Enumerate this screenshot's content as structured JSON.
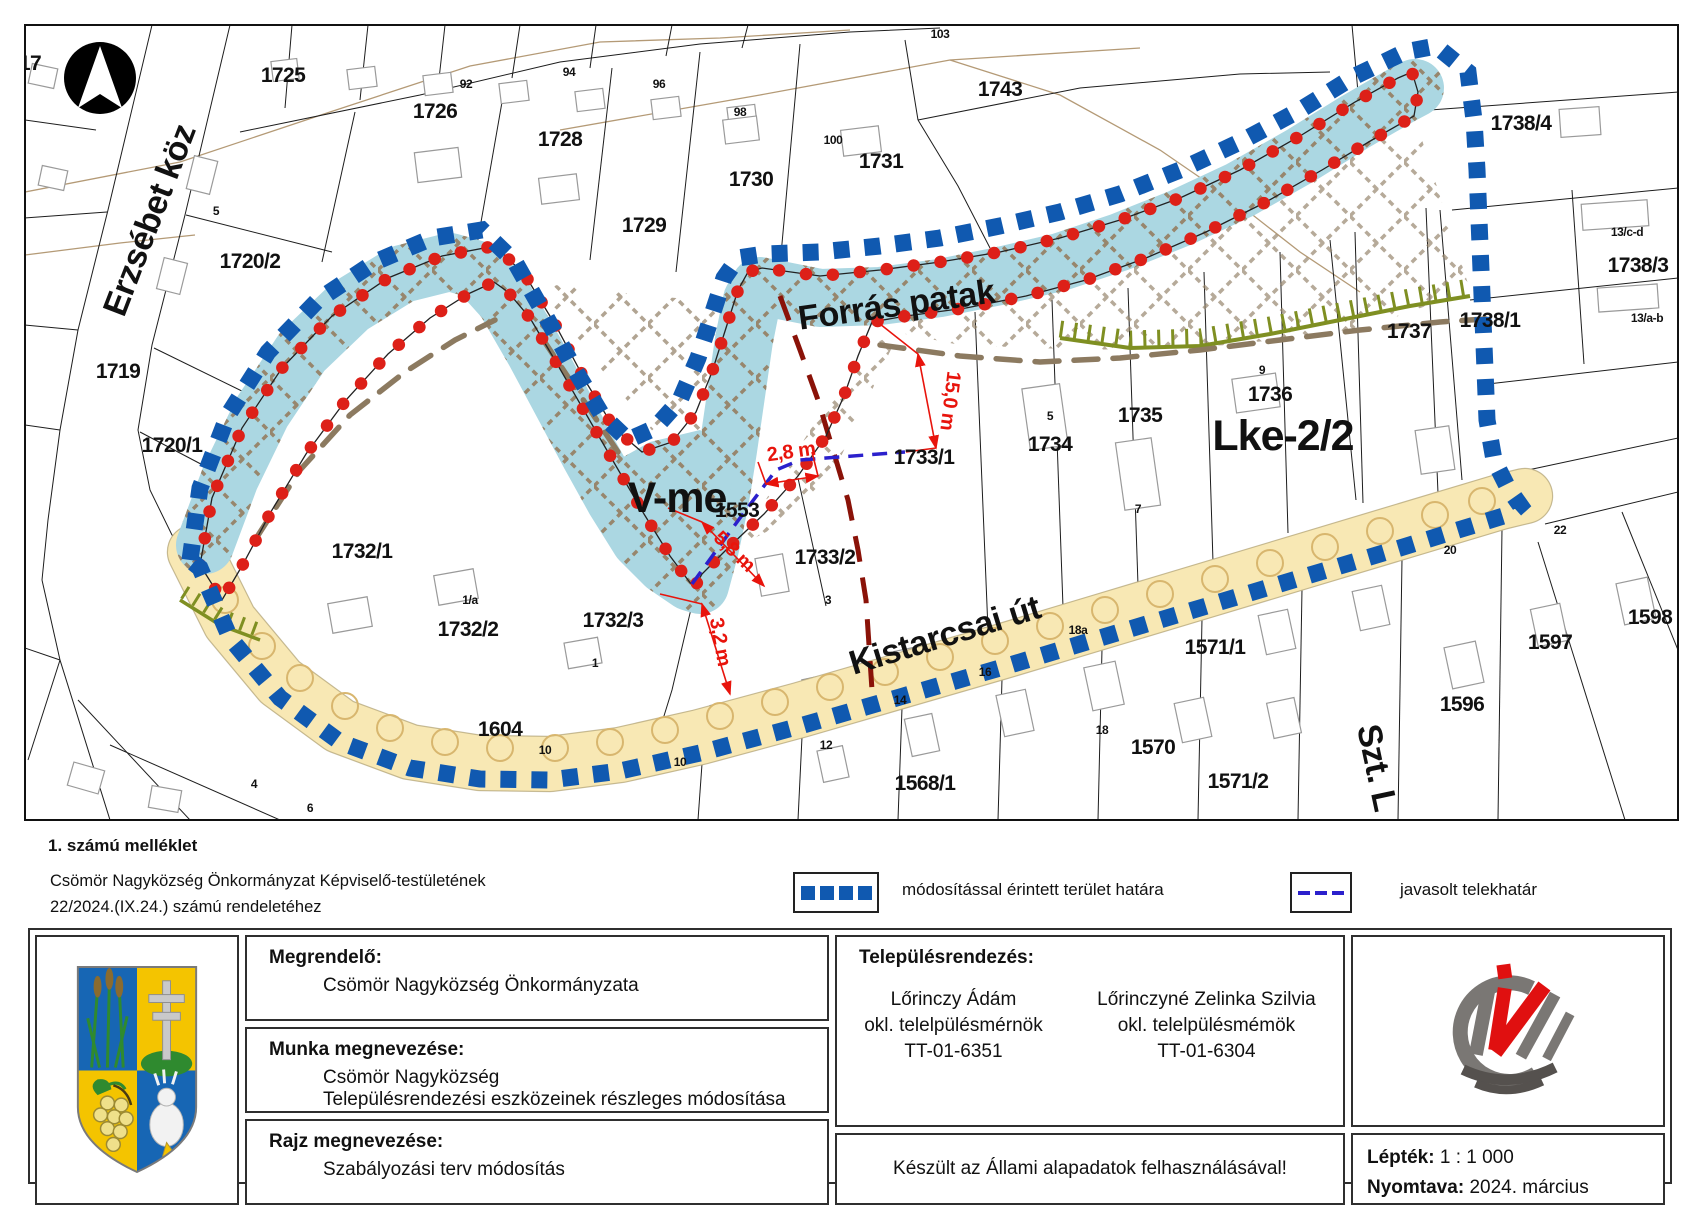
{
  "notes": {
    "attachment": "1. számú melléklet",
    "line1": "Csömör Nagyközség Önkormányzat Képviselő-testületének",
    "line2": "22/2024.(IX.24.) számú rendeletéhez"
  },
  "legend": {
    "items": [
      {
        "symbol": "blue-squares",
        "label": "módosítással érintett terület határa"
      },
      {
        "symbol": "blue-dash",
        "label": "javasolt telekhatár"
      }
    ]
  },
  "titleblock": {
    "client_label": "Megrendelő:",
    "client": "Csömör Nagyközség Önkormányzata",
    "work_label": "Munka megnevezése:",
    "work_line1": "Csömör Nagyközség",
    "work_line2": "Településrendezési eszközeinek részleges módosítása",
    "drawing_label": "Rajz megnevezése:",
    "drawing": "Szabályozási terv módosítás",
    "planning_label": "Településrendezés:",
    "planners": [
      {
        "name": "Lőrinczy Ádám",
        "title": "okl. telelpülésmérnök",
        "reg": "TT-01-6351"
      },
      {
        "name": "Lőrinczyné Zelinka Szilvia",
        "title": "okl. telelpülésmémök",
        "reg": "TT-01-6304"
      }
    ],
    "base_note": "Készült az Állami alapadatok felhasználásával!",
    "scale_label": "Lépték:",
    "scale": "1 : 1 000",
    "printed_label": "Nyomtava:",
    "printed": "2024. március"
  },
  "map": {
    "zone_labels": [
      {
        "t": "V-me",
        "x": 677,
        "y": 512,
        "rot": 0
      },
      {
        "t": "Lke-2/2",
        "x": 1283,
        "y": 450,
        "rot": 0
      }
    ],
    "street_labels": [
      {
        "t": "Erzsébet köz",
        "x": 160,
        "y": 224,
        "rot": -69
      },
      {
        "t": "Forrás patak",
        "x": 898,
        "y": 316,
        "rot": -8
      },
      {
        "t": "Kistarcsai út",
        "x": 948,
        "y": 646,
        "rot": -17
      },
      {
        "t": "Szt. L",
        "x": 1366,
        "y": 770,
        "rot": 78
      }
    ],
    "parcel_labels": [
      {
        "t": "17",
        "x": 30,
        "y": 70
      },
      {
        "t": "1725",
        "x": 283,
        "y": 82
      },
      {
        "t": "1726",
        "x": 435,
        "y": 118
      },
      {
        "t": "1728",
        "x": 560,
        "y": 146
      },
      {
        "t": "1729",
        "x": 644,
        "y": 232
      },
      {
        "t": "1730",
        "x": 751,
        "y": 186
      },
      {
        "t": "1731",
        "x": 881,
        "y": 168
      },
      {
        "t": "1743",
        "x": 1000,
        "y": 96
      },
      {
        "t": "1720/2",
        "x": 250,
        "y": 268
      },
      {
        "t": "1719",
        "x": 118,
        "y": 378
      },
      {
        "t": "1720/1",
        "x": 172,
        "y": 452
      },
      {
        "t": "1732/1",
        "x": 362,
        "y": 558
      },
      {
        "t": "1732/2",
        "x": 468,
        "y": 636
      },
      {
        "t": "1732/3",
        "x": 613,
        "y": 627
      },
      {
        "t": "1553",
        "x": 737,
        "y": 517
      },
      {
        "t": "1733/1",
        "x": 924,
        "y": 464
      },
      {
        "t": "1733/2",
        "x": 825,
        "y": 564
      },
      {
        "t": "1734",
        "x": 1050,
        "y": 451
      },
      {
        "t": "1735",
        "x": 1140,
        "y": 422
      },
      {
        "t": "1736",
        "x": 1270,
        "y": 401
      },
      {
        "t": "1737",
        "x": 1409,
        "y": 338
      },
      {
        "t": "1738/1",
        "x": 1490,
        "y": 327
      },
      {
        "t": "1738/4",
        "x": 1521,
        "y": 130
      },
      {
        "t": "1738/3",
        "x": 1638,
        "y": 272
      },
      {
        "t": "1598",
        "x": 1650,
        "y": 624
      },
      {
        "t": "1597",
        "x": 1550,
        "y": 649
      },
      {
        "t": "1596",
        "x": 1462,
        "y": 711
      },
      {
        "t": "1571/1",
        "x": 1215,
        "y": 654
      },
      {
        "t": "1570",
        "x": 1153,
        "y": 754
      },
      {
        "t": "1571/2",
        "x": 1238,
        "y": 788
      },
      {
        "t": "1568/1",
        "x": 925,
        "y": 790
      },
      {
        "t": "1604",
        "x": 500,
        "y": 736
      }
    ],
    "house_numbers": [
      {
        "t": "92",
        "x": 466,
        "y": 88
      },
      {
        "t": "94",
        "x": 569,
        "y": 76
      },
      {
        "t": "96",
        "x": 659,
        "y": 88
      },
      {
        "t": "98",
        "x": 740,
        "y": 116
      },
      {
        "t": "100",
        "x": 833,
        "y": 144
      },
      {
        "t": "103",
        "x": 940,
        "y": 38
      },
      {
        "t": "5",
        "x": 216,
        "y": 215
      },
      {
        "t": "1/a",
        "x": 470,
        "y": 604
      },
      {
        "t": "1",
        "x": 595,
        "y": 667
      },
      {
        "t": "3",
        "x": 828,
        "y": 604
      },
      {
        "t": "5",
        "x": 1050,
        "y": 420
      },
      {
        "t": "7",
        "x": 1138,
        "y": 513
      },
      {
        "t": "9",
        "x": 1262,
        "y": 374
      },
      {
        "t": "10",
        "x": 545,
        "y": 754
      },
      {
        "t": "10",
        "x": 680,
        "y": 766
      },
      {
        "t": "12",
        "x": 826,
        "y": 749
      },
      {
        "t": "14",
        "x": 900,
        "y": 704
      },
      {
        "t": "16",
        "x": 985,
        "y": 676
      },
      {
        "t": "18",
        "x": 1102,
        "y": 734
      },
      {
        "t": "18a",
        "x": 1078,
        "y": 634
      },
      {
        "t": "20",
        "x": 1450,
        "y": 554
      },
      {
        "t": "22",
        "x": 1560,
        "y": 534
      },
      {
        "t": "13/c-d",
        "x": 1627,
        "y": 236
      },
      {
        "t": "13/a-b",
        "x": 1647,
        "y": 322
      },
      {
        "t": "4",
        "x": 254,
        "y": 788
      },
      {
        "t": "6",
        "x": 310,
        "y": 812
      }
    ],
    "dimension_labels": [
      {
        "t": "15,0 m",
        "x": 944,
        "y": 400,
        "rot": 97
      },
      {
        "t": "2,8 m",
        "x": 792,
        "y": 458,
        "rot": -8
      },
      {
        "t": "5,8 m",
        "x": 730,
        "y": 556,
        "rot": 44
      },
      {
        "t": "3,2 m",
        "x": 714,
        "y": 643,
        "rot": 80
      }
    ],
    "colors": {
      "boundary_blue": "#1059b0",
      "parcel_dot_red": "#dd2018",
      "water_blue": "#abd7e2",
      "road_fill": "#f8e8b4",
      "road_tree": "#d8b66e",
      "proposed_line_blue": "#2b20cc",
      "old_boundary_maroon": "#8a1208",
      "embankment_olive": "#7f8f22",
      "hatch_brown": "#97866d",
      "dashed_brown": "#8c7a60",
      "dimension_red": "#e8140c"
    }
  }
}
